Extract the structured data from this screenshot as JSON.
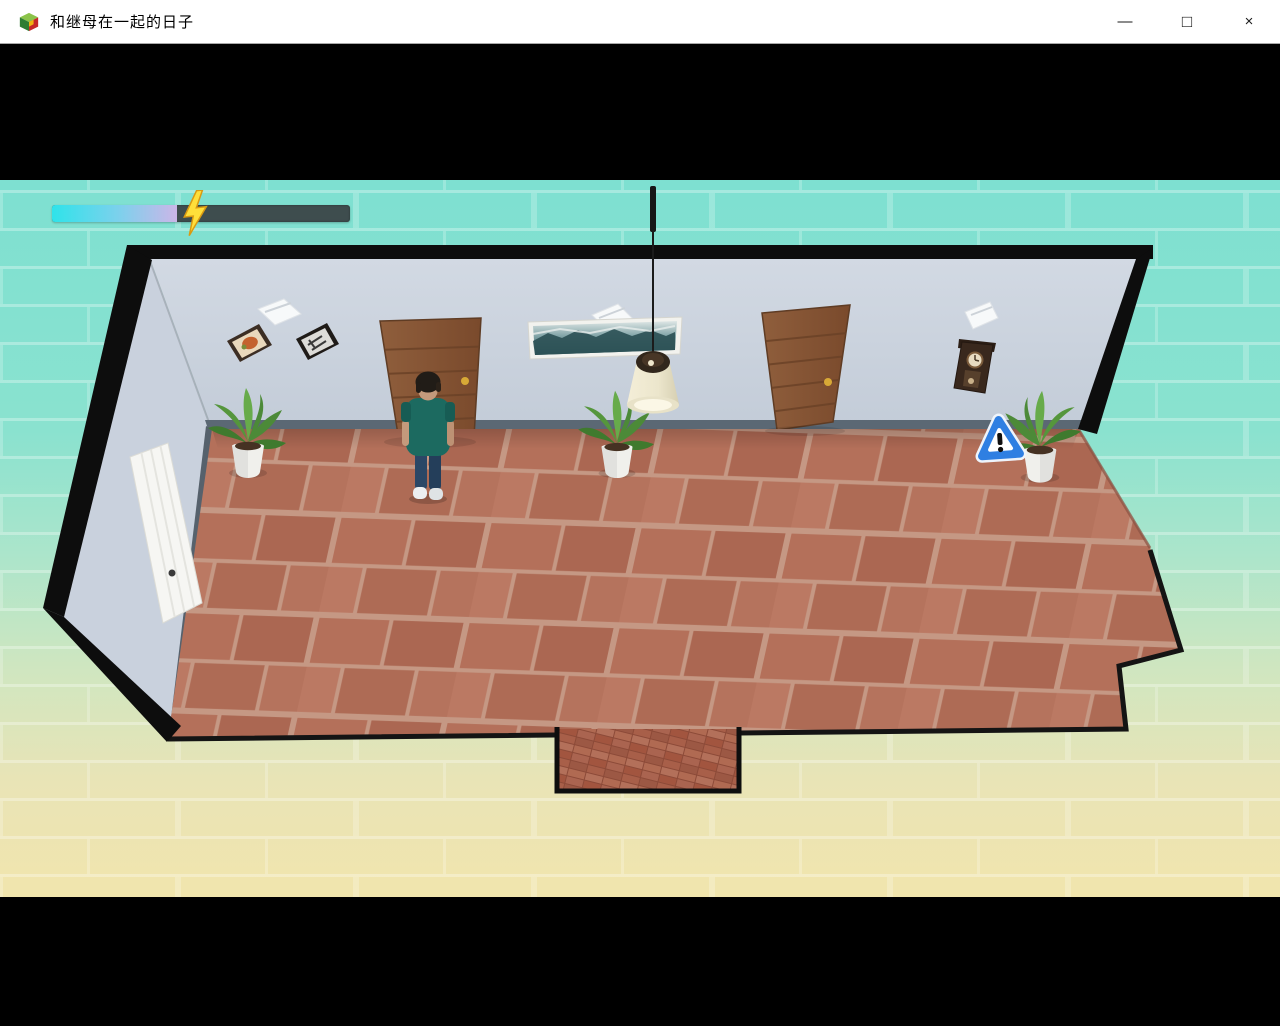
{
  "window": {
    "title": "和继母在一起的日子",
    "icon": "game-cube-icon",
    "controls": {
      "minimize": "—",
      "maximize": "□",
      "close": "×"
    }
  },
  "hud": {
    "energy": {
      "percent": 42,
      "icon": "lightning-bolt"
    }
  },
  "scene": {
    "objects": [
      {
        "name": "back-wall"
      },
      {
        "name": "left-wall"
      },
      {
        "name": "white-door-left-wall"
      },
      {
        "name": "wooden-door-left"
      },
      {
        "name": "wooden-door-right"
      },
      {
        "name": "seascape-painting"
      },
      {
        "name": "picture-frame-food"
      },
      {
        "name": "picture-frame-clock"
      },
      {
        "name": "wall-vent-left"
      },
      {
        "name": "wall-vent-center"
      },
      {
        "name": "wall-vent-right"
      },
      {
        "name": "pendulum-wall-clock"
      },
      {
        "name": "pendant-lamp"
      },
      {
        "name": "potted-plant-left"
      },
      {
        "name": "potted-plant-center"
      },
      {
        "name": "potted-plant-right"
      },
      {
        "name": "warning-sign"
      },
      {
        "name": "player-character"
      },
      {
        "name": "terracotta-floor"
      },
      {
        "name": "entry-mat"
      }
    ]
  },
  "palette": {
    "bg_top": "#7ee0d1",
    "bg_mid": "#abe5cb",
    "bg_cream": "#f1e5ad",
    "wall": "#d2d9e3",
    "wall_dark": "#c3ccd8",
    "baseboard": "#5b6874",
    "floor_grout": "#c59884",
    "floor_tile": "#b4705a",
    "door": "#8f5e3c",
    "door_dark": "#7a4a2c",
    "energy_track": "#3e4d4e",
    "energy_c1": "#2fe3ea",
    "energy_c2": "#7fd0ec",
    "energy_c3": "#cbb6e8",
    "bolt_yellow": "#ffdf3a",
    "sign_blue": "#2f7fe2",
    "plant_green": "#4c8a38",
    "shirt_teal": "#1c6a60",
    "jeans_blue": "#2b4766"
  }
}
